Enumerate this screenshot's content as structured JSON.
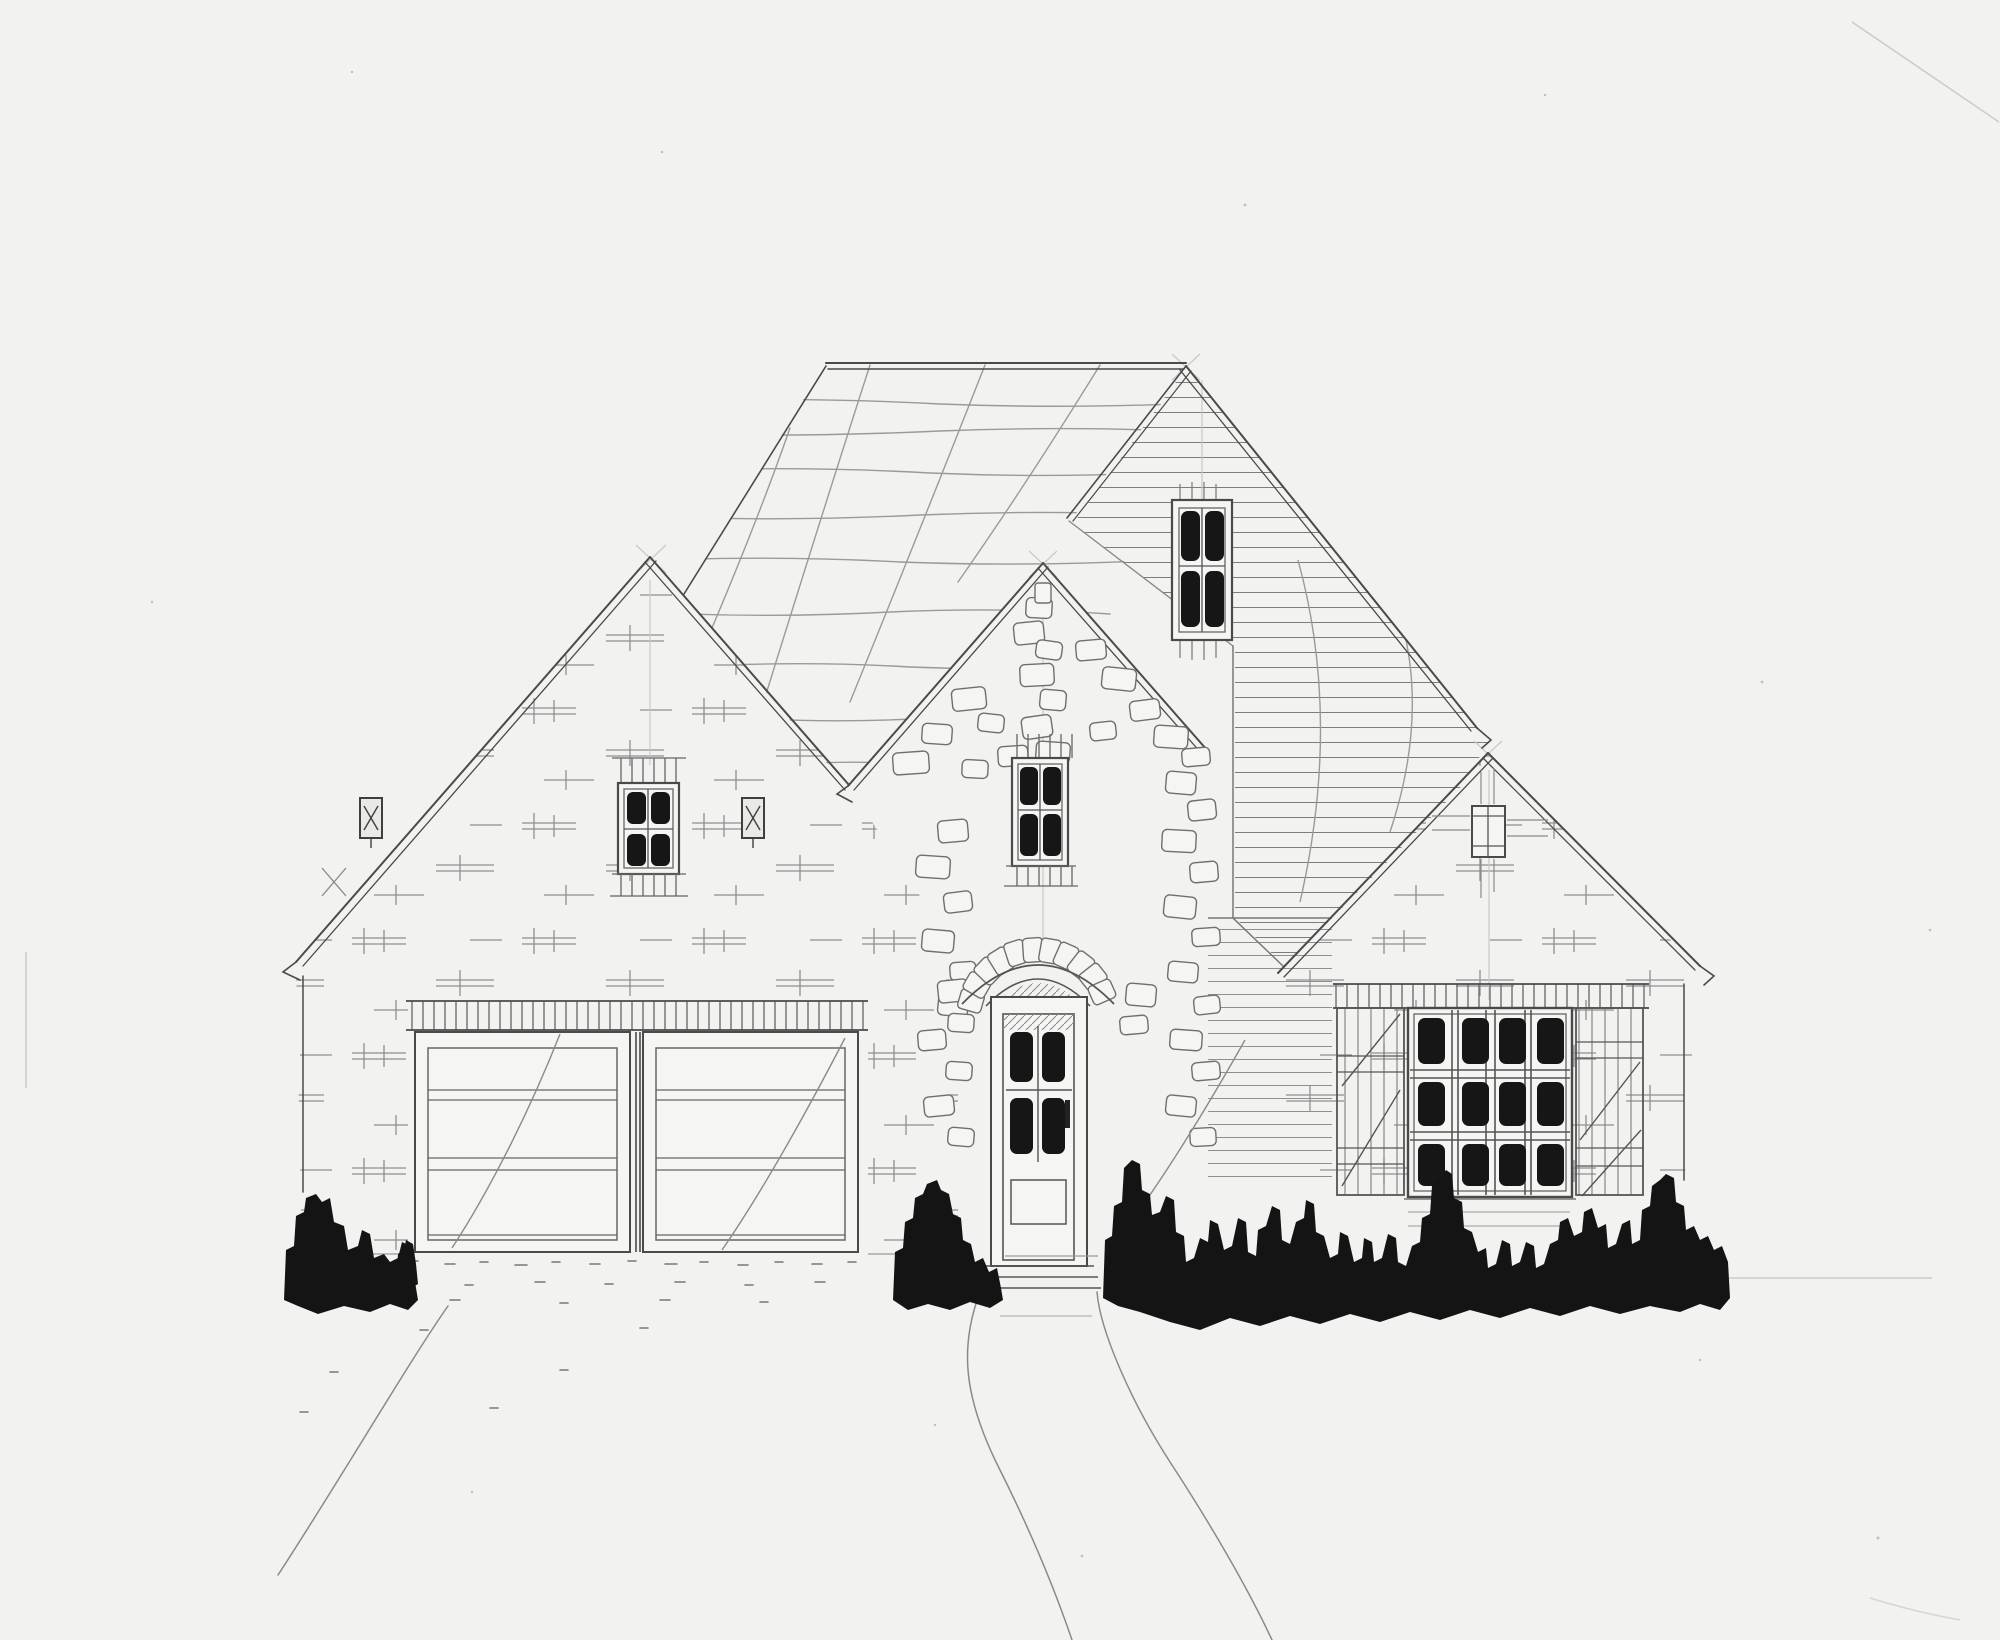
{
  "document": {
    "kind": "hand-drawn architectural front elevation sketch",
    "subject": "single-story cottage with three front-facing gables, brick and stone facade",
    "medium": "graphite pencil with black marker accents on white paper"
  },
  "palette": {
    "paper": "#f2f2f0",
    "ink_dark": "#3f3f3f",
    "pencil_mid": "#6b6b6b",
    "pencil_light": "#9a9a9a",
    "construction": "#c9c9c9",
    "marker_black": "#141414"
  },
  "features": {
    "roof": {
      "ridge_orientation": "horizontal",
      "left_plane_hatch": "sparse wavy horizontal shingle lines with curved seams",
      "rear_gable_cladding": "horizontal lap siding",
      "front_gables": 3
    },
    "garage": {
      "doors": 2,
      "panels_per_door": 4,
      "header": "soldier-course brick band"
    },
    "front_door": {
      "glass_panes": 4,
      "lower_panel": 1,
      "surround": "irregular stone blocks",
      "arch": "stone voussoir arch with hatched tympanum",
      "steps": 3
    },
    "windows": [
      {
        "name": "left-gable-window",
        "panes": 4,
        "trim": "soldier brick header and ticked sill"
      },
      {
        "name": "center-gable-window",
        "panes": 4,
        "surround": "stone blocks"
      },
      {
        "name": "rear-gable-window",
        "panes": 4,
        "cladding_context": "siding"
      },
      {
        "name": "right-gable-attic-vent",
        "panes": 2
      },
      {
        "name": "right-picture-window",
        "panes": 12,
        "grid": "4 columns x 3 rows",
        "shutters": "board shutters with diagonal braces",
        "header": "soldier-course band"
      }
    ],
    "landscape": {
      "bush_clusters": 4,
      "bush_style": "solid black marker blobs",
      "driveway": "speckled paving flaring toward lower left",
      "front_walk": "double-edged path angling to lower right"
    }
  }
}
